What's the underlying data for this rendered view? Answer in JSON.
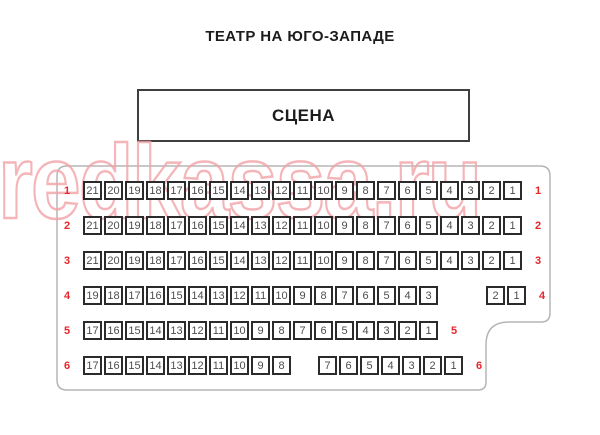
{
  "title": "ТЕАТР НА ЮГО-ЗАПАДЕ",
  "stage": {
    "label": "СЦЕНА"
  },
  "watermark": {
    "text": "redkassa.ru",
    "color": "#f2a3a8"
  },
  "colors": {
    "row_label": "#e8252b",
    "seat_border": "#2b2b2b",
    "seat_number": "#4d4d4d",
    "hall_outline": "#b5b5b5",
    "stage_border": "#3f3f3f"
  },
  "rows": [
    {
      "label": "1",
      "groups": [
        [
          21,
          20,
          19,
          18,
          17,
          16,
          15,
          14,
          13,
          12,
          11,
          10,
          9,
          8,
          7,
          6,
          5,
          4,
          3,
          2,
          1
        ]
      ]
    },
    {
      "label": "2",
      "groups": [
        [
          21,
          20,
          19,
          18,
          17,
          16,
          15,
          14,
          13,
          12,
          11,
          10,
          9,
          8,
          7,
          6,
          5,
          4,
          3,
          2,
          1
        ]
      ]
    },
    {
      "label": "3",
      "groups": [
        [
          21,
          20,
          19,
          18,
          17,
          16,
          15,
          14,
          13,
          12,
          11,
          10,
          9,
          8,
          7,
          6,
          5,
          4,
          3,
          2,
          1
        ]
      ]
    },
    {
      "label": "4",
      "groups": [
        [
          19,
          18,
          17,
          16,
          15,
          14,
          13,
          12,
          11,
          10,
          9,
          8,
          7,
          6,
          5,
          4,
          3
        ],
        [
          2,
          1
        ]
      ]
    },
    {
      "label": "5",
      "groups": [
        [
          17,
          16,
          15,
          14,
          13,
          12,
          11,
          10,
          9,
          8,
          7,
          6,
          5,
          4,
          3,
          2,
          1
        ]
      ]
    },
    {
      "label": "6",
      "groups": [
        [
          17,
          16,
          15,
          14,
          13,
          12,
          11,
          10,
          9,
          8
        ],
        [
          7,
          6,
          5,
          4,
          3,
          2,
          1
        ]
      ]
    }
  ]
}
